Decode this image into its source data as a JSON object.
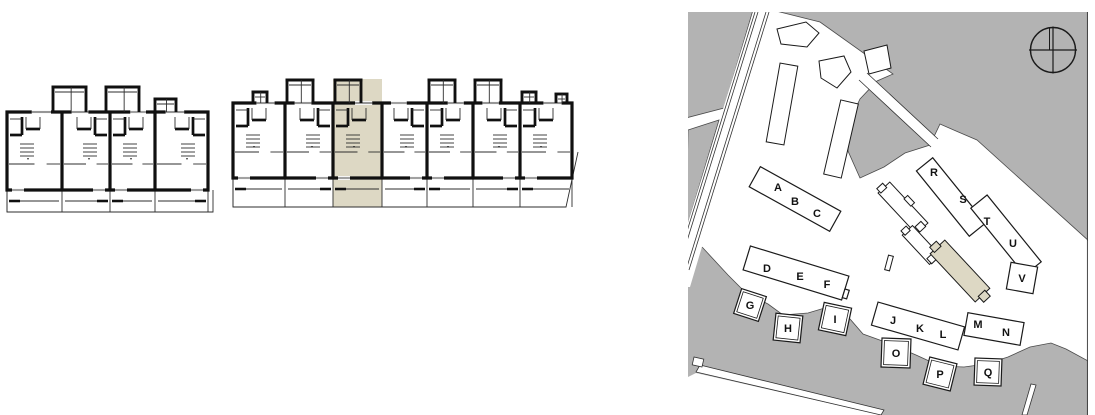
{
  "colors": {
    "highlight": "#ddd8c4",
    "map_gray": "#b3b3b3",
    "wall": "#101010",
    "thin_line": "#2e2e2e",
    "outline": "#1a1a1a",
    "white": "#ffffff"
  },
  "floor_plans": {
    "left": {
      "units": 4,
      "highlighted_unit": null
    },
    "right": {
      "units": 7,
      "highlighted_unit": 3
    }
  },
  "site_plan": {
    "building_labels": [
      "A",
      "B",
      "C",
      "D",
      "E",
      "F",
      "G",
      "H",
      "I",
      "J",
      "K",
      "L",
      "M",
      "N",
      "O",
      "P",
      "Q",
      "R",
      "S",
      "T",
      "U",
      "V"
    ],
    "building_groups": [
      "A-B-C",
      "D-E-F",
      "G",
      "H",
      "I",
      "J-K-L",
      "M-N",
      "O",
      "P",
      "Q",
      "R-S",
      "T-U",
      "V"
    ],
    "has_highlighted_building": true,
    "compass_icon": "north-compass"
  }
}
